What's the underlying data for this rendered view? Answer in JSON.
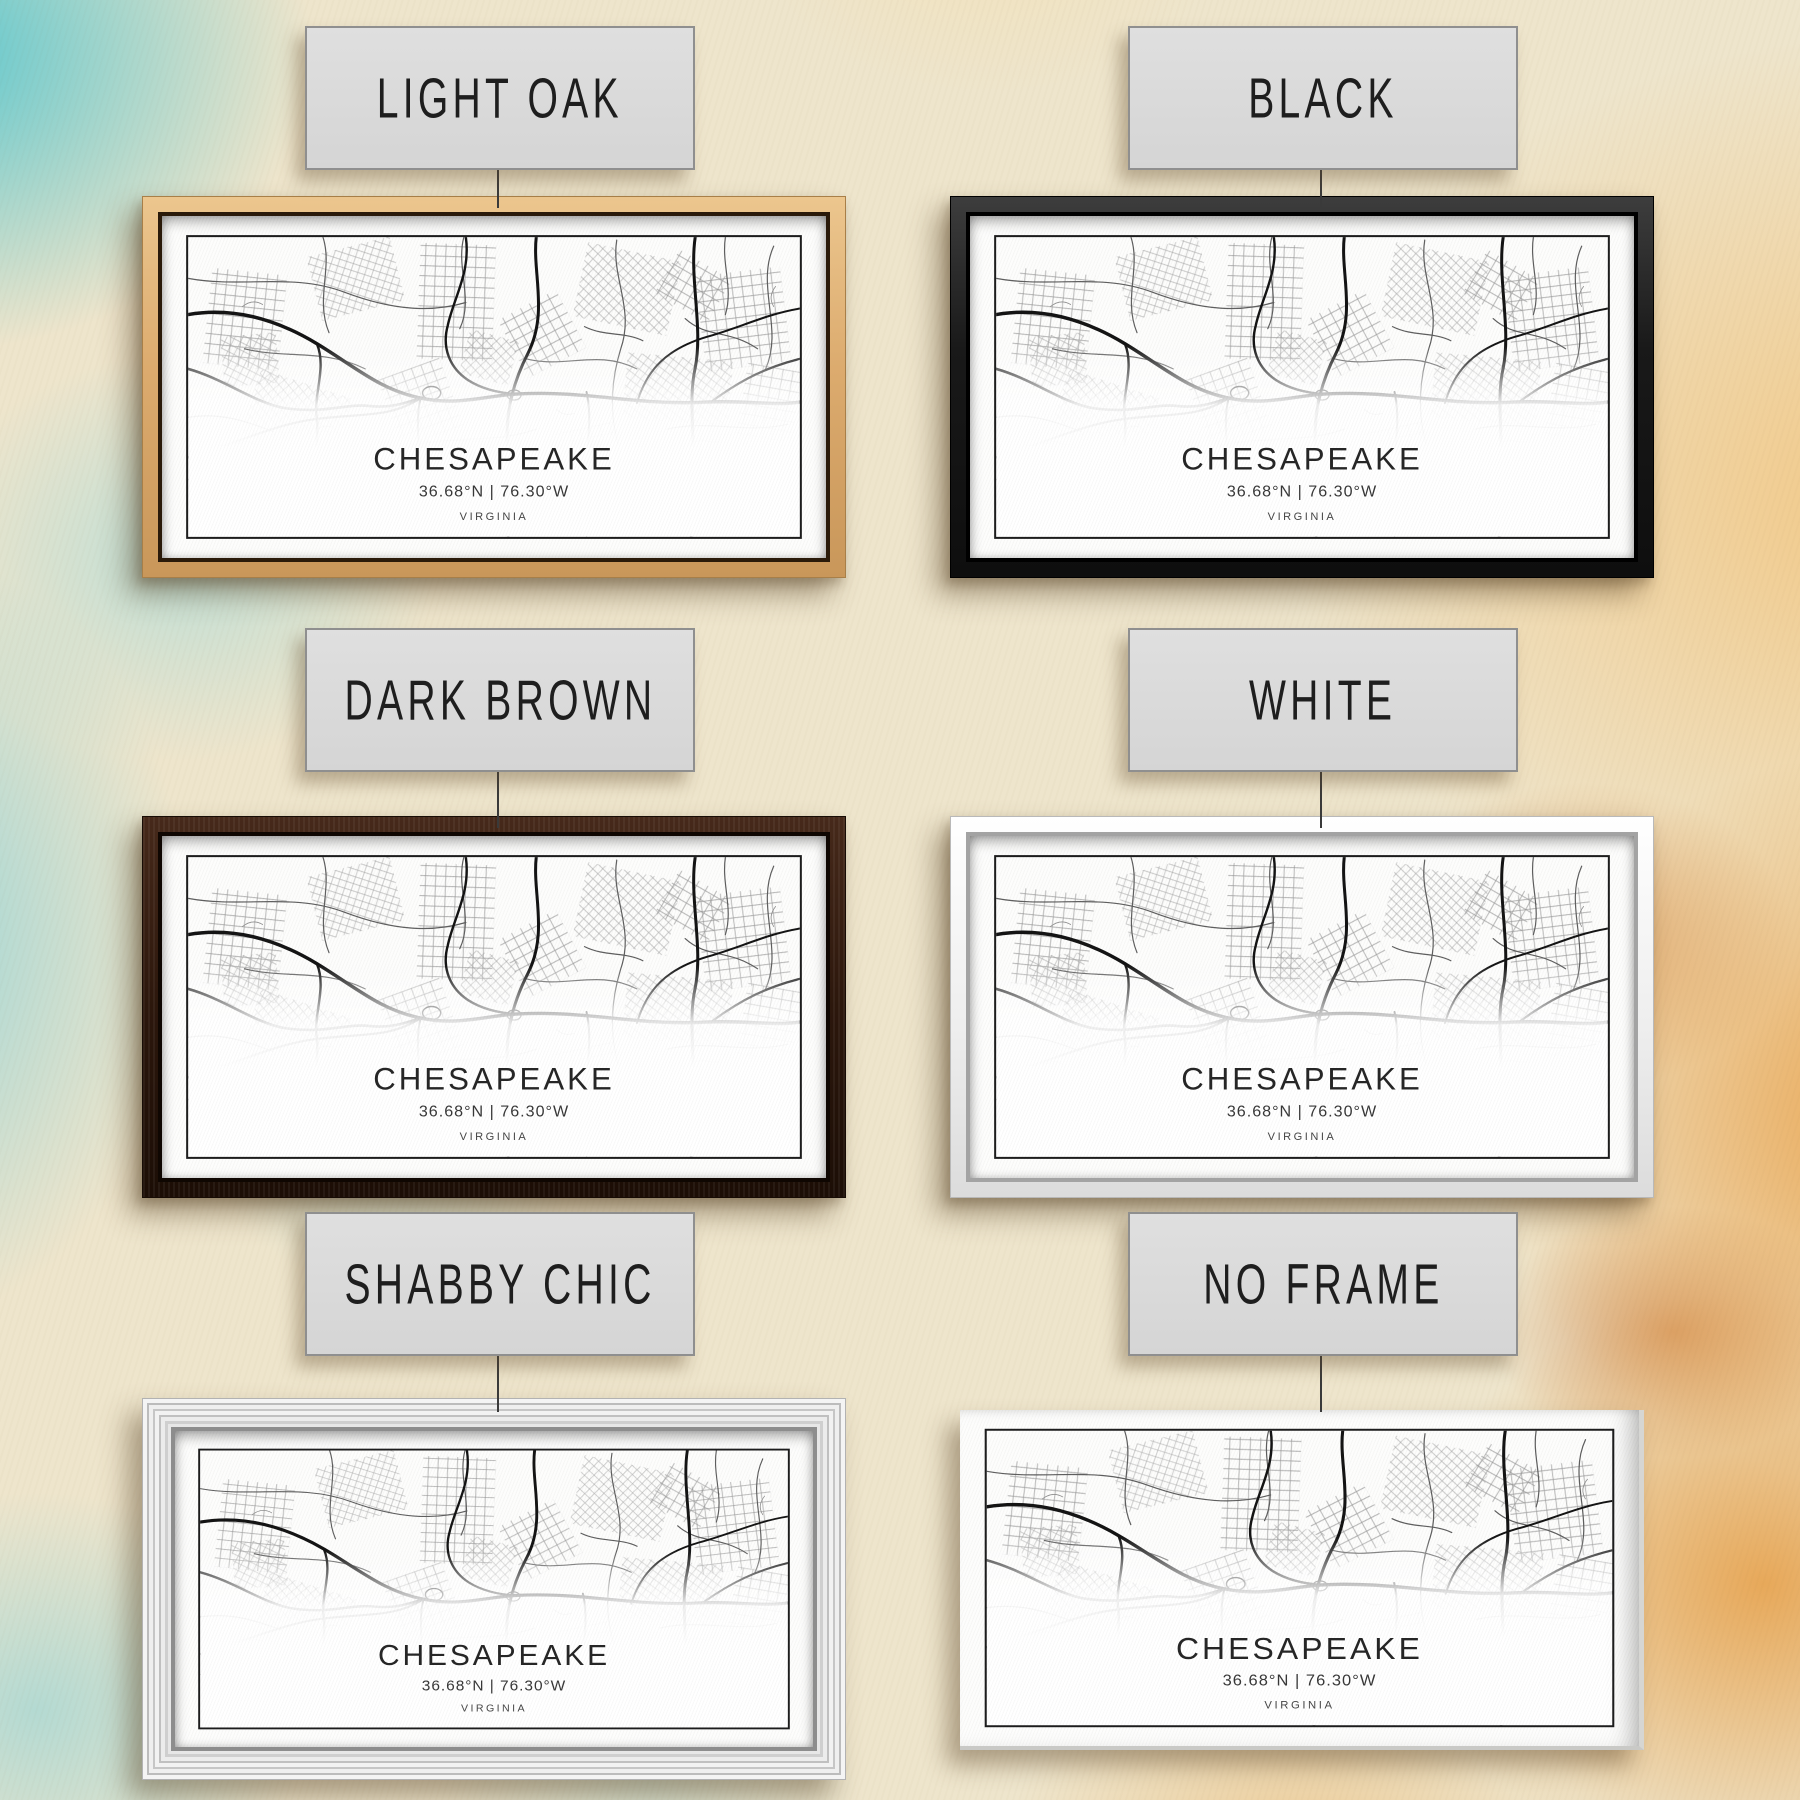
{
  "print": {
    "city": "CHESAPEAKE",
    "coordinates": "36.68°N | 76.30°W",
    "state": "VIRGINIA"
  },
  "frame_options": [
    {
      "label": "LIGHT OAK",
      "frame_color": "#d9a96c"
    },
    {
      "label": "BLACK",
      "frame_color": "#1a1a1a"
    },
    {
      "label": "DARK BROWN",
      "frame_color": "#2c170c"
    },
    {
      "label": "WHITE",
      "frame_color": "#f2f2f2"
    },
    {
      "label": "SHABBY CHIC",
      "frame_color": "#e7e7e7"
    },
    {
      "label": "NO FRAME",
      "frame_color": null
    }
  ],
  "colors": {
    "wall_teal": "#62c6cd",
    "wall_cream": "#eee5cc",
    "wall_orange": "#e89c3e",
    "label_background": "#d9d9d9",
    "label_border": "#8f8f8f",
    "map_ink": "#1c1c1c",
    "canvas_white": "#fdfdfc"
  }
}
